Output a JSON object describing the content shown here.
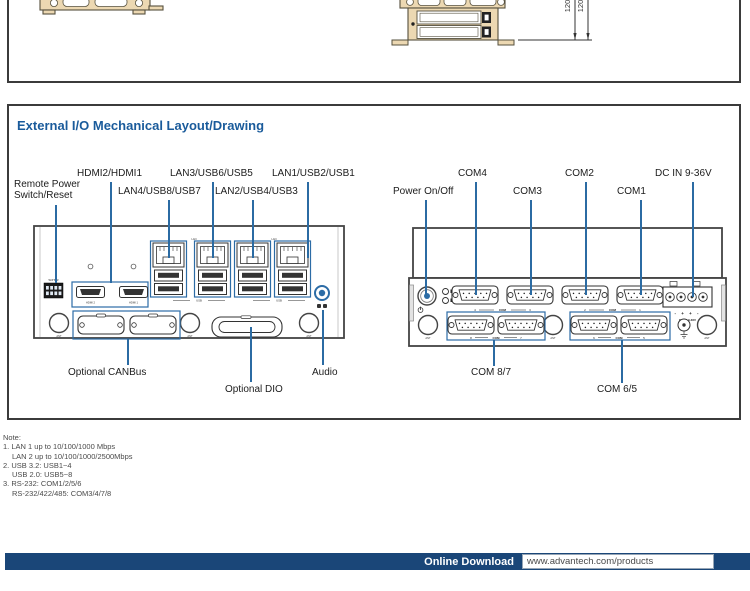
{
  "top_figure": {
    "dim_a": "120",
    "dim_b": "120"
  },
  "section": {
    "title": "External I/O Mechanical Layout/Drawing"
  },
  "front_panel": {
    "labels": {
      "remote_power_l1": "Remote Power",
      "remote_power_l2": "Switch/Reset",
      "hdmi": "HDMI2/HDMI1",
      "lan4": "LAN4/USB8/USB7",
      "lan3": "LAN3/USB6/USB5",
      "lan2": "LAN2/USB4/USB3",
      "lan1": "LAN1/USB2/USB1",
      "canbus": "Optional CANBus",
      "dio": "Optional DIO",
      "audio": "Audio"
    },
    "tiny": {
      "sw": "W/P B/R",
      "hdmi2": "HDMI 2",
      "hdmi1": "HDMI 1",
      "lan": "LAN",
      "usb": "USB",
      "ant": "ANT"
    }
  },
  "rear_panel": {
    "labels": {
      "power": "Power On/Off",
      "com4": "COM4",
      "com3": "COM3",
      "com2": "COM2",
      "com1": "COM1",
      "dcin": "DC IN 9-36V",
      "com87": "COM 8/7",
      "com65": "COM 6/5"
    },
    "tiny": {
      "com": "COM",
      "n1": "1",
      "n2": "2",
      "n3": "3",
      "n4": "4",
      "n5": "5",
      "n6": "6",
      "n7": "7",
      "n8": "8",
      "ant": "ANT",
      "dc_marks": "- + + -",
      "dc_small": "DC IN 9-36V"
    }
  },
  "notes": {
    "heading": "Note:",
    "line1": "1. LAN 1 up to 10/100/1000 Mbps",
    "line1b": "LAN 2 up to 10/100/1000/2500Mbps",
    "line2": "2. USB 3.2: USB1~4",
    "line2b": "USB 2.0: USB5~8",
    "line3": "3. RS-232: COM1/2/5/6",
    "line3b": "RS-232/422/485: COM3/4/7/8"
  },
  "footer": {
    "download_label": "Online Download",
    "url": "www.advantech.com/products"
  }
}
